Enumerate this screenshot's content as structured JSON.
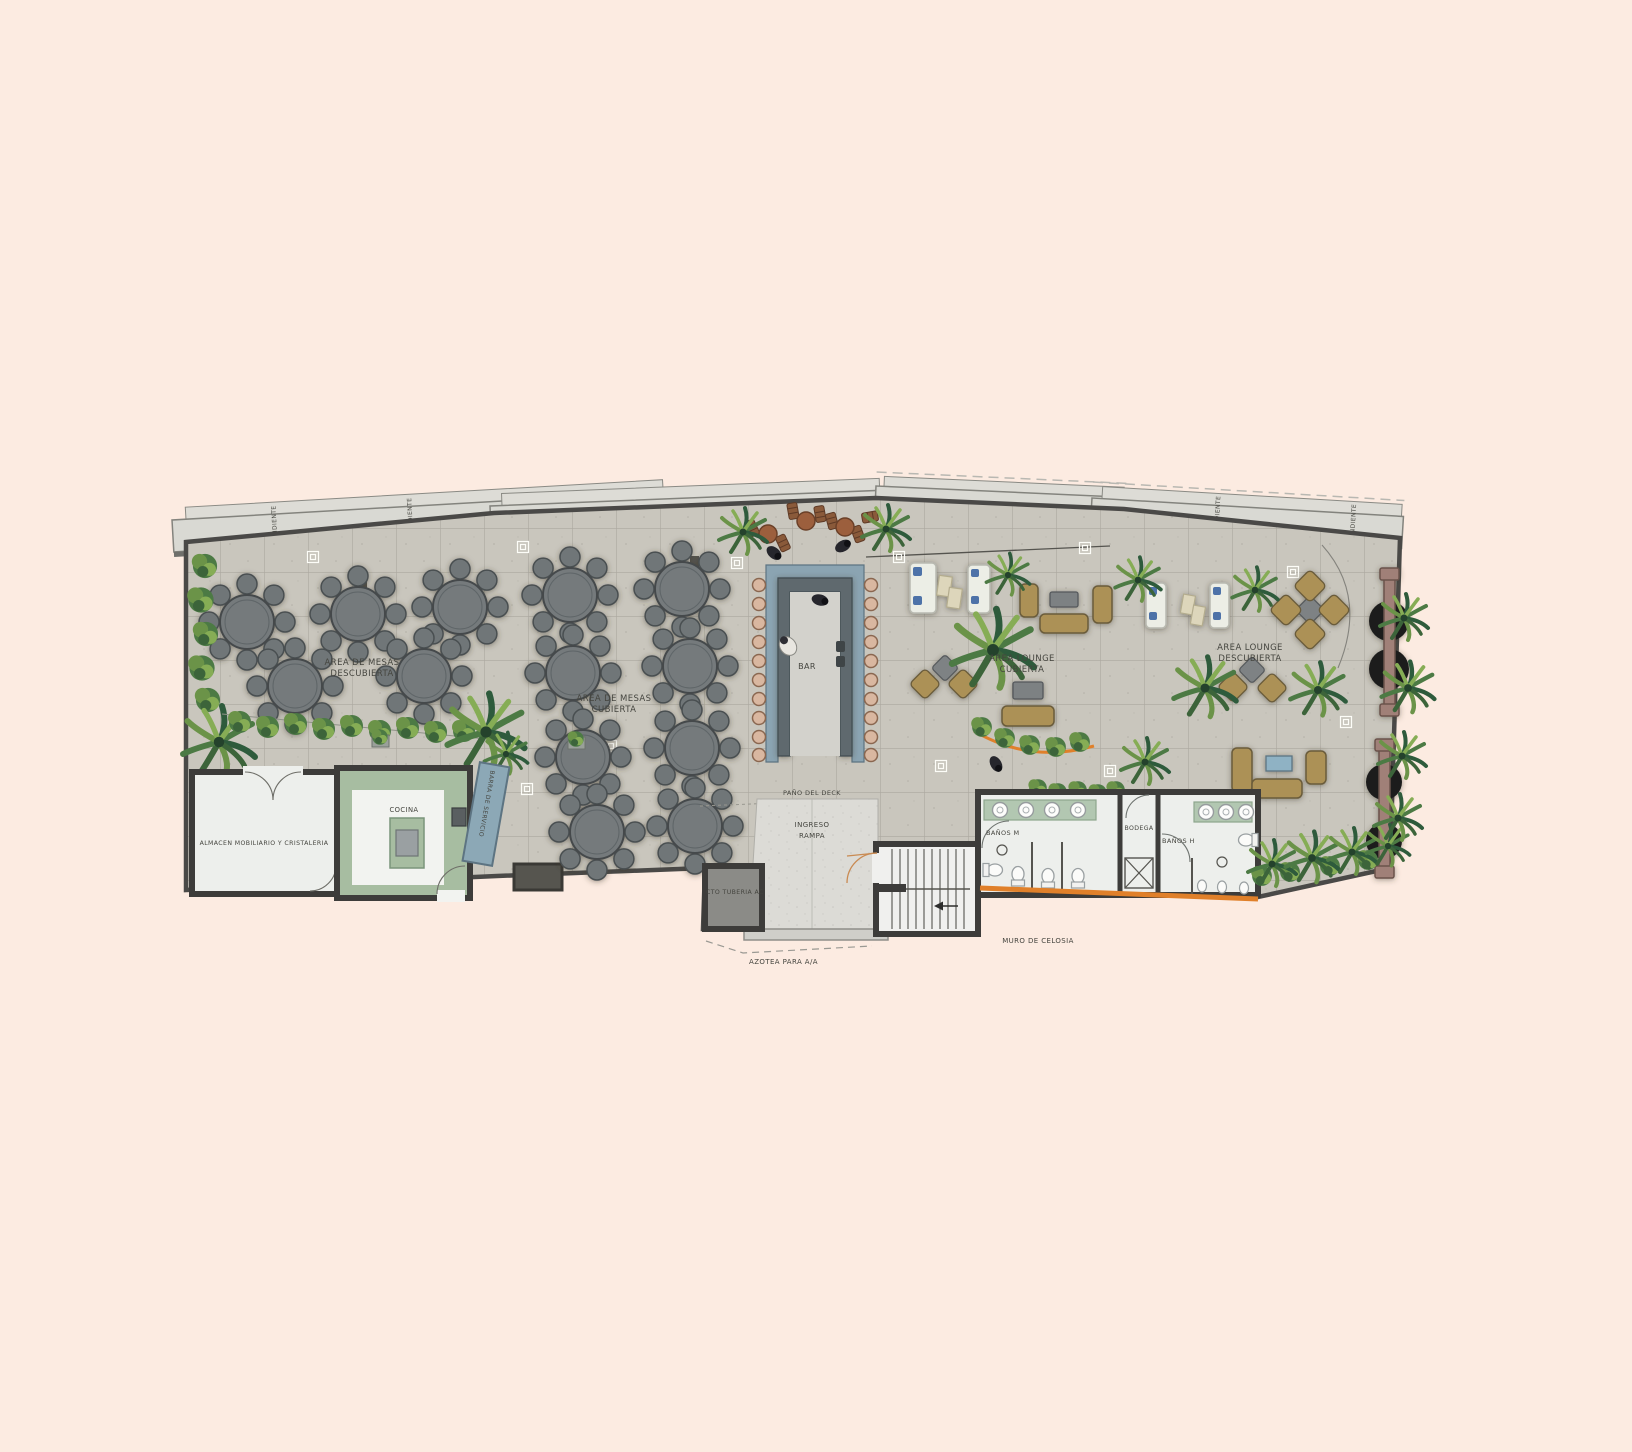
{
  "page": {
    "background_color": "#fcebe1"
  },
  "plan": {
    "labels": {
      "pendiente": "PENDIENTE",
      "area_mesas_descubierta": {
        "line1": "AREA DE MESAS",
        "line2": "DESCUBIERTA"
      },
      "area_mesas_cubierta": {
        "line1": "AREA DE MESAS",
        "line2": "CUBIERTA"
      },
      "bar": "BAR",
      "area_lounge_cubierta": {
        "line1": "AREA LOUNGE",
        "line2": "CUBIERTA"
      },
      "area_lounge_descubierta": {
        "line1": "AREA LOUNGE",
        "line2": "DESCUBIERTA"
      },
      "barra_de_servicio": "BARRA DE SERVICIO",
      "cocina": "COCINA",
      "almacen": "ALMACEN MOBILIARIO Y CRISTALERIA",
      "pano_del_deck": "PAÑO DEL DECK",
      "ingreso_rampa": {
        "line1": "INGRESO",
        "line2": "RAMPA"
      },
      "cto_tuberia": "CTO TUBERIA AC",
      "azotea": "AZOTEA PARA A/A",
      "muro_de_celosia": "MURO DE CELOSIA",
      "banos_m": "BAÑOS M",
      "bodega": "BODEGA",
      "banos_h": "BAÑOS H"
    },
    "colors": {
      "background": "#fcebe1",
      "floor_tile": "#c9c6bd",
      "tile_grout": "#aba89f",
      "wall": "#3d3c3a",
      "canopy": "#d9d9d3",
      "dining_table": "#707678",
      "bar_counter": "#5e696e",
      "bar_top": "#8ba4b2",
      "stool": "#d9b7a0",
      "lounge_seat": "#ac9157",
      "lounge_table": "#7d8183",
      "sofa": "#eceee6",
      "sofa_cushion": "#4e72a8",
      "kitchen_counter": "#a7bda1",
      "service_bar": "#8ca8b6",
      "sink_counter": "#b2c7b1",
      "lattice_wall": "#e0802a",
      "bench_beam": "#a08078",
      "plant_green": "#4c7a44",
      "ramp_concrete": "#dcdbd6",
      "label_text": "#45453f"
    },
    "furniture": {
      "round_dining_tables_uncovered": 5,
      "round_dining_tables_covered": 8,
      "chairs_per_round_table": 8,
      "bar_stools": 20,
      "sinks_banos_m": 4,
      "sinks_banos_h": 3,
      "hanging_bench_structures": 2
    }
  }
}
